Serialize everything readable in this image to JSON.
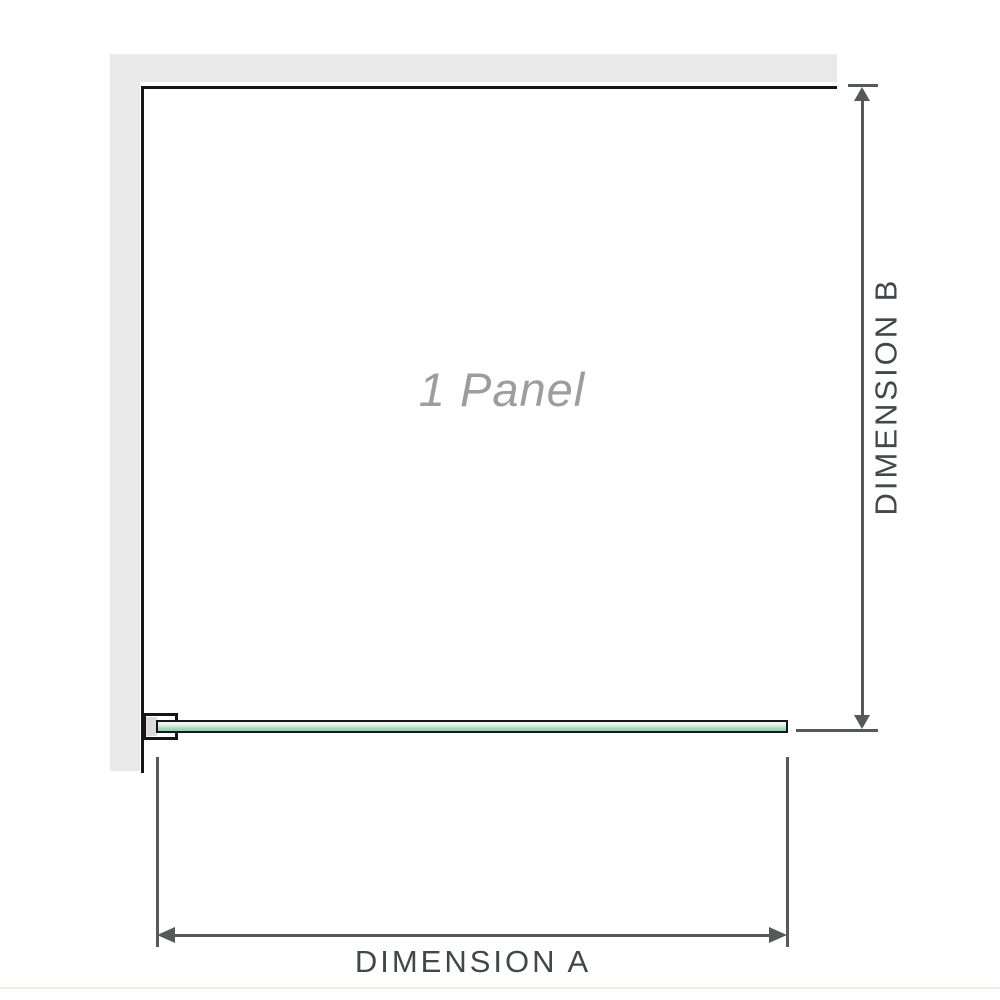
{
  "diagram": {
    "labels": {
      "panel": "1 Panel",
      "dimension_a": "DIMENSION A",
      "dimension_b": "DIMENSION B"
    }
  },
  "colors": {
    "wall_gray": "#e9e9e9",
    "outline_black": "#161616",
    "bracket_pad_gray": "#dcdcdc",
    "glass_green": "#a5dabb",
    "dimension_gray": "#56585a",
    "label_gray": "#43464a",
    "panel_text_gray": "#9d9d9d",
    "bottom_rule": "#ecebe5"
  }
}
